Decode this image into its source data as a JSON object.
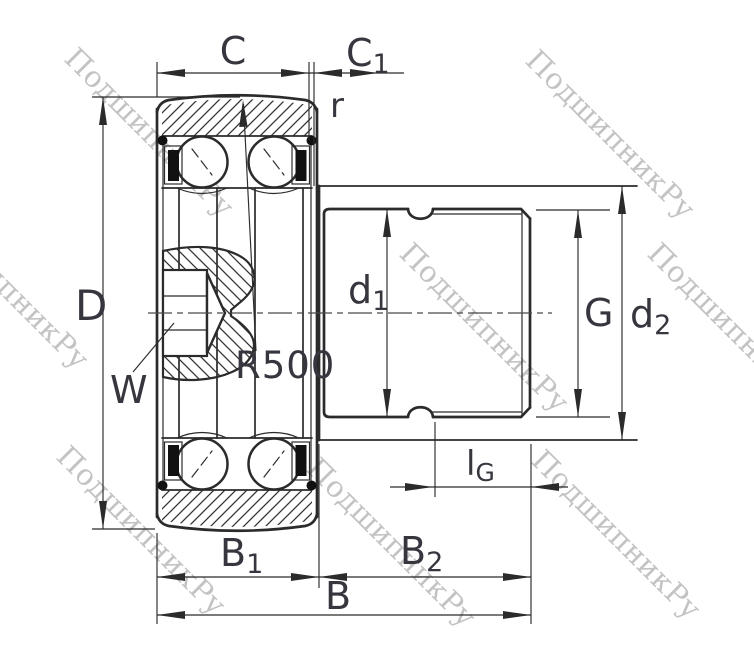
{
  "dims": {
    "C": "C",
    "C1": {
      "base": "C",
      "sub": "1"
    },
    "r": "r",
    "D": "D",
    "W": "W",
    "R500": "R500",
    "d1": {
      "base": "d",
      "sub": "1"
    },
    "G": "G",
    "d2": {
      "base": "d",
      "sub": "2"
    },
    "lG": {
      "base": "l",
      "sub": "G"
    },
    "B1": {
      "base": "B",
      "sub": "1"
    },
    "B2": {
      "base": "B",
      "sub": "2"
    },
    "B": "B"
  },
  "watermark": {
    "text": "ПодшипникРу",
    "color": "#b5b5b5",
    "instances": [
      {
        "x": 63,
        "y": 60
      },
      {
        "x": 524,
        "y": 62
      },
      {
        "x": -82,
        "y": 212
      },
      {
        "x": 398,
        "y": 255
      },
      {
        "x": 646,
        "y": 255
      },
      {
        "x": 55,
        "y": 458
      },
      {
        "x": 305,
        "y": 470
      },
      {
        "x": 530,
        "y": 462
      }
    ]
  },
  "colors": {
    "line": "#2b2b2b",
    "label": "#36363e",
    "seal": "#111111",
    "background": "#ffffff",
    "watermark": "#b5b5b5"
  }
}
